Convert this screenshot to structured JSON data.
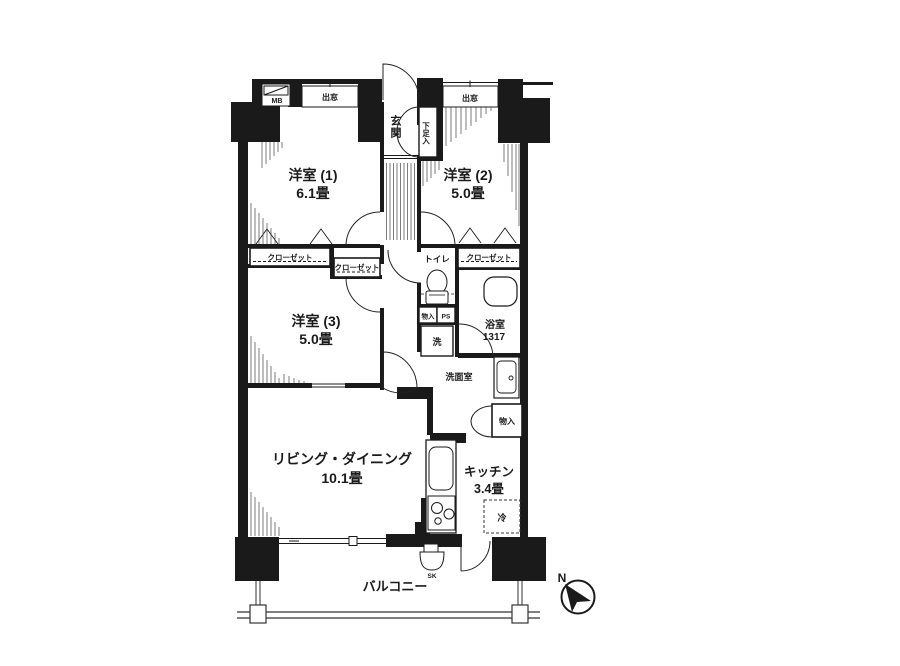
{
  "floorplan": {
    "colors": {
      "wall": "#1a1a1a",
      "line": "#2a2a2a",
      "bg": "#ffffff"
    },
    "rooms": {
      "room1": {
        "name": "洋室 (1)",
        "size": "6.1畳"
      },
      "room2": {
        "name": "洋室 (2)",
        "size": "5.0畳"
      },
      "room3": {
        "name": "洋室 (3)",
        "size": "5.0畳"
      },
      "living_dining": {
        "name": "リビング・ダイニング",
        "size": "10.1畳"
      },
      "kitchen": {
        "name": "キッチン",
        "size": "3.4畳"
      },
      "bathroom": {
        "name": "浴室",
        "size": "1317"
      },
      "washroom": {
        "name": "洗面室"
      },
      "toilet": {
        "name": "トイレ"
      },
      "entrance": {
        "name": "玄関"
      },
      "balcony": {
        "name": "バルコニー"
      }
    },
    "fixtures": {
      "meter_box": "MB",
      "bay_window_1": "出窓",
      "bay_window_2": "出窓",
      "closet_room1": "クローゼット",
      "closet_room3": "クローゼット",
      "closet_room2": "クローゼット",
      "shoe_cabinet": "下足入",
      "storage_hall": "物入",
      "pipe_space_hall": "PS",
      "washer": "洗",
      "storage_kitchen": "物入",
      "refrigerator": "冷",
      "pipe_space_kitchen": "PS",
      "slop_sink": "SK",
      "compass_north": "N"
    }
  }
}
